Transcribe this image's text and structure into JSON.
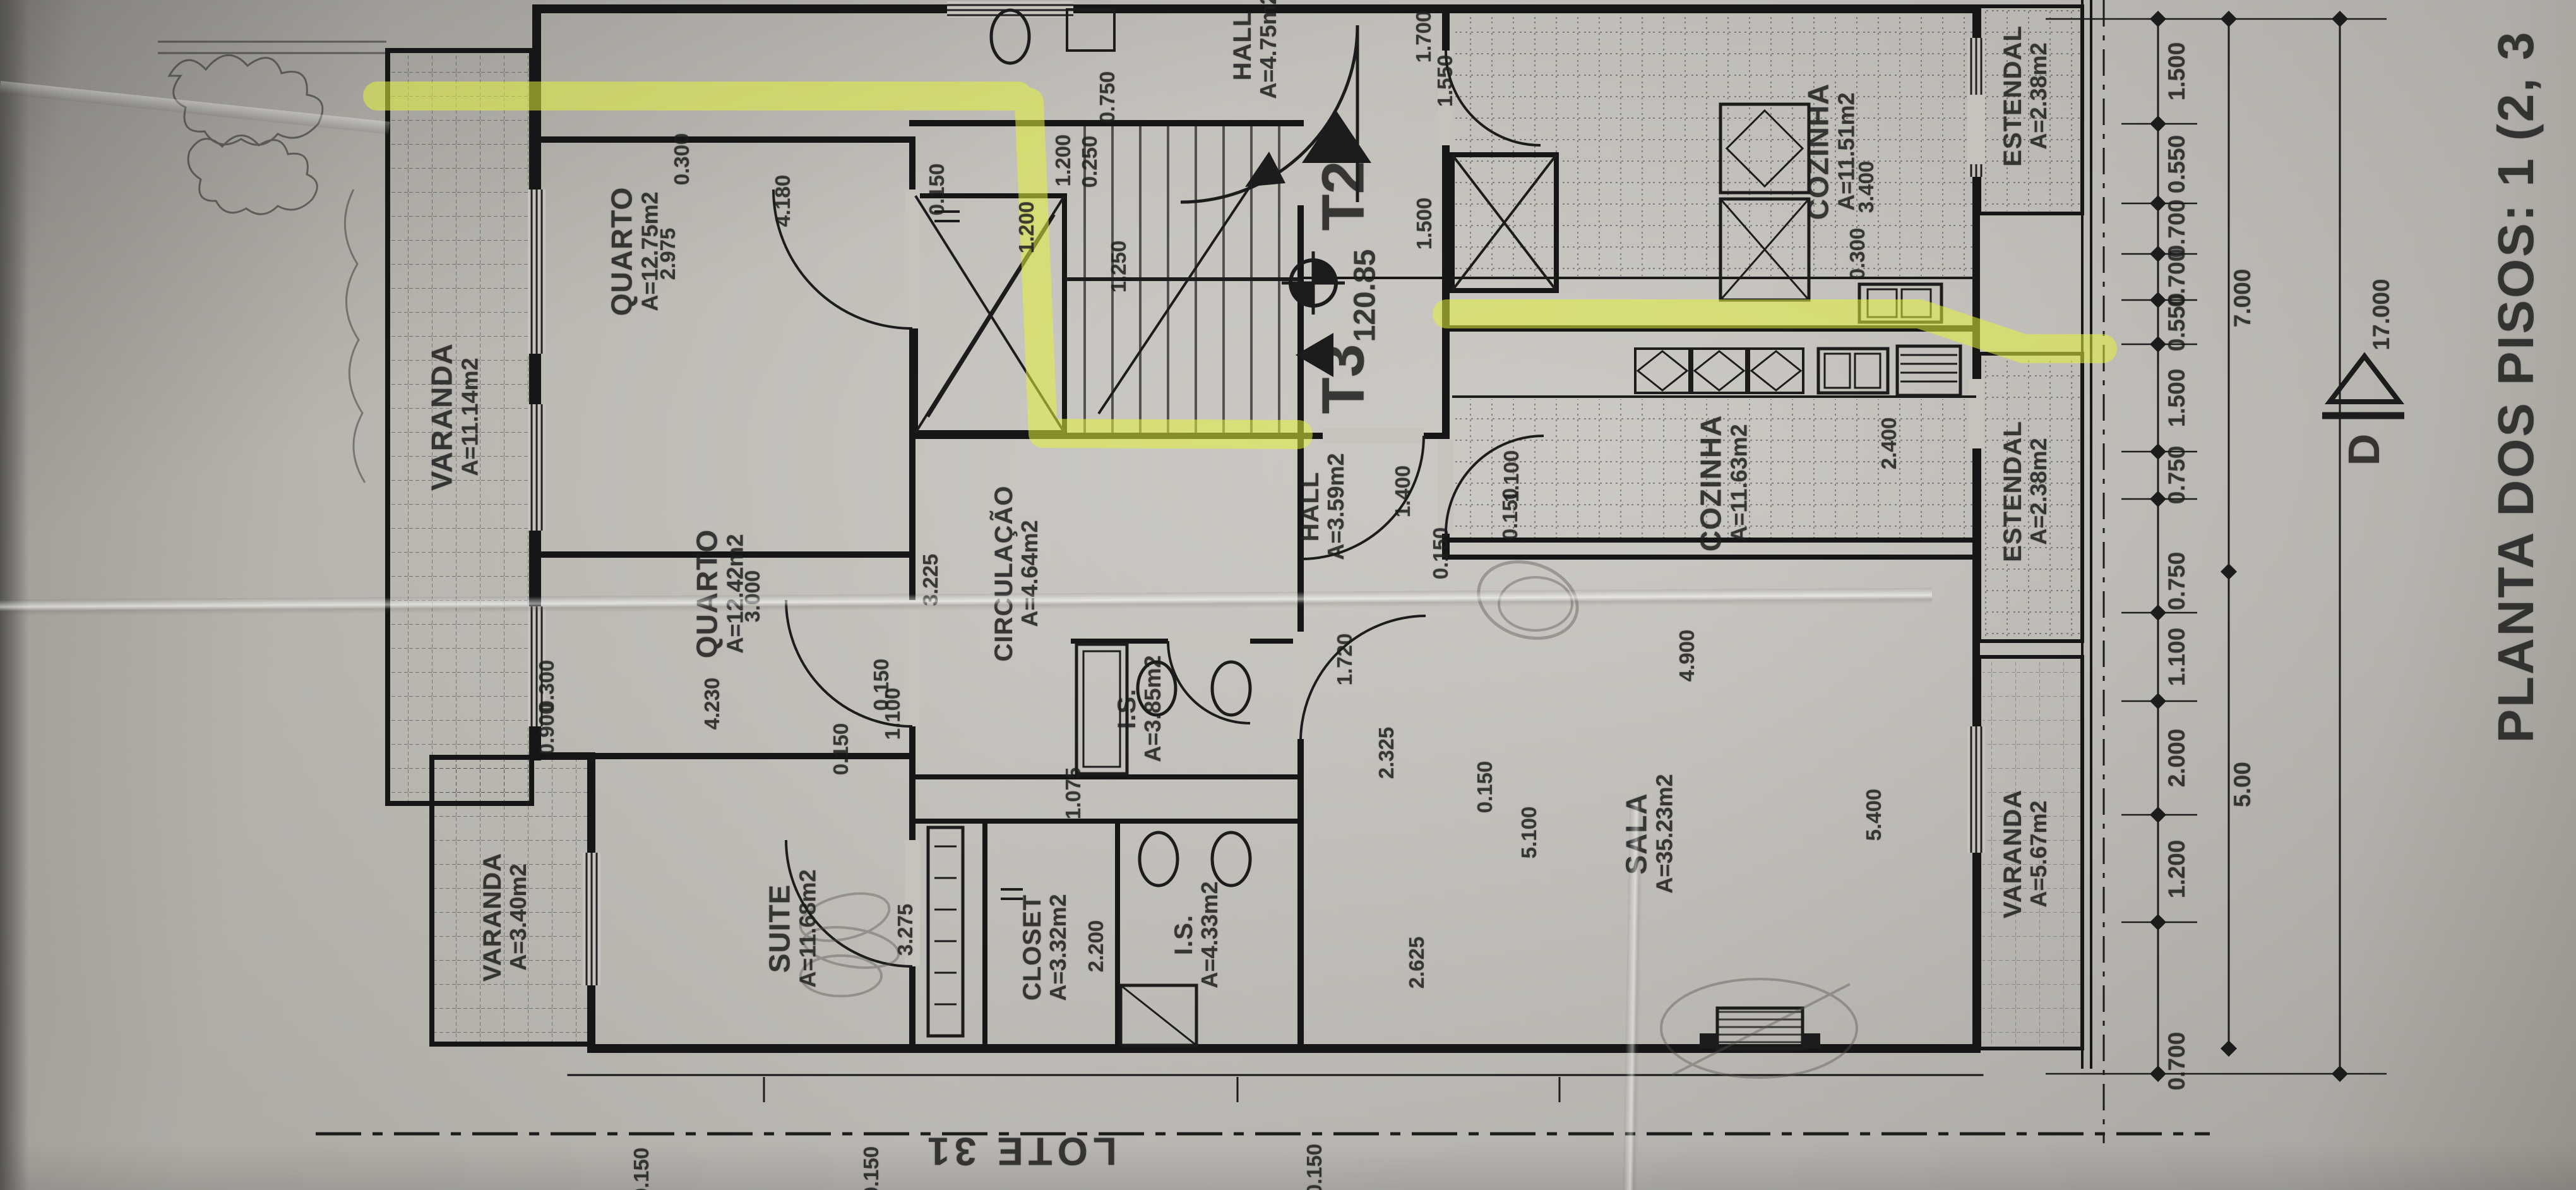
{
  "title": {
    "text": "PLANTA DOS PISOS: 1 (2, 3"
  },
  "lot": {
    "text": "LOTE 31"
  },
  "core": {
    "t2": "T2",
    "t3": "T3",
    "elevation": "120.85",
    "section": "D"
  },
  "highlight_color": "#e3f13c",
  "rooms": [
    {
      "name": "VARANDA",
      "area": "A=11.14m2"
    },
    {
      "name": "QUARTO",
      "area": "A=12.75m2"
    },
    {
      "name": "QUARTO",
      "area": "A=12.42m2"
    },
    {
      "name": "SUITE",
      "area": "A=11.68m2"
    },
    {
      "name": "CLOSET",
      "area": "A=3.32m2"
    },
    {
      "name": "I.S.",
      "area": "A=4.33m2"
    },
    {
      "name": "I.S.",
      "area": "A=3.85m2"
    },
    {
      "name": "CIRCULAÇÃO",
      "area": "A=4.64m2"
    },
    {
      "name": "HALL",
      "area": "A=3.59m2"
    },
    {
      "name": "HALL",
      "area": "A=4.75m2"
    },
    {
      "name": "COZINHA",
      "area": "A=11.51m2"
    },
    {
      "name": "ESTENDAL",
      "area": "A=2.38m2"
    },
    {
      "name": "COZINHA",
      "area": "A=11.63m2"
    },
    {
      "name": "ESTENDAL",
      "area": "A=2.38m2"
    },
    {
      "name": "SALA",
      "area": "A=35.23m2"
    },
    {
      "name": "VARANDA",
      "area": "A=5.67m2"
    },
    {
      "name": "VARANDA",
      "area": "A=3.40m2"
    }
  ],
  "dims": [
    "0.300",
    "2.975",
    "4.180",
    "3.000",
    "4.230",
    "0.300",
    "0.900",
    "0.150",
    "3.275",
    "2.200",
    "1.075",
    "3.225",
    "0.150",
    "1.100",
    "1.400",
    "1.720",
    "2.325",
    "0.150",
    "2.625",
    "5.100",
    "0.150",
    "5.400",
    "4.900",
    "1.100",
    "0.150",
    "2.400",
    "0.300",
    "3.400",
    "1.200",
    "0.250",
    "1.200",
    "0.750",
    "0.150",
    "1.700",
    "1.550",
    "0.150",
    "0.150",
    "0.150",
    "1.500",
    "1.250"
  ],
  "chains": {
    "inner": [
      "1.500",
      "0.550",
      "0.700",
      "0.700",
      "0.550",
      "1.500",
      "0.750",
      "0.750",
      "1.100",
      "2.000",
      "1.200",
      "0.700"
    ],
    "middle": [
      "7.000",
      "5.00"
    ],
    "outer": [
      "17.000"
    ]
  }
}
